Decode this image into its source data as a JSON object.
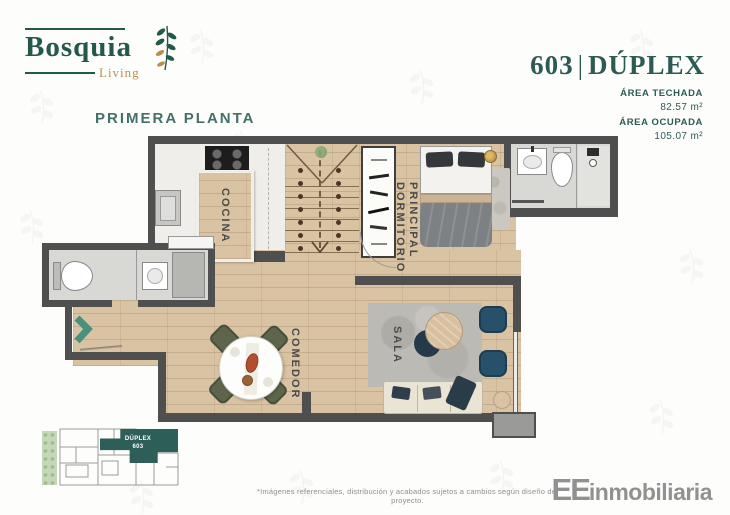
{
  "header": {
    "logo": {
      "name": "Bosquia",
      "tagline": "Living"
    },
    "floor_label": "PRIMERA PLANTA",
    "unit": {
      "number": "603",
      "separator": "|",
      "type": "DÚPLEX"
    },
    "areas": [
      {
        "label": "ÁREA TECHADA",
        "value": "82.57 m²"
      },
      {
        "label": "ÁREA OCUPADA",
        "value": "105.07 m²"
      }
    ]
  },
  "floorplan": {
    "rooms": {
      "cocina": "COCINA",
      "comedor": "COMEDOR",
      "sala": "SALA",
      "dormitorio_line1": "DORMITORIO",
      "dormitorio_line2": "PRINCIPAL"
    }
  },
  "keyplan": {
    "unit_label": "DÚPLEX",
    "unit_number": "603"
  },
  "footer": {
    "disclaimer": "*Imágenes referenciales, distribución y acabados sujetos a cambios según diseño del proyecto.",
    "brand_bold": "EE",
    "brand_rest": "inmobiliaria"
  },
  "colors": {
    "brand_green": "#24584a",
    "brand_gold": "#bb8e4f",
    "teal_heading": "#2d5a54",
    "wall": "#4f4f4f",
    "wood_floor": "#d9c3a3",
    "entry_arrow": "#49917f",
    "keyplan_unit": "#2d5f58"
  }
}
